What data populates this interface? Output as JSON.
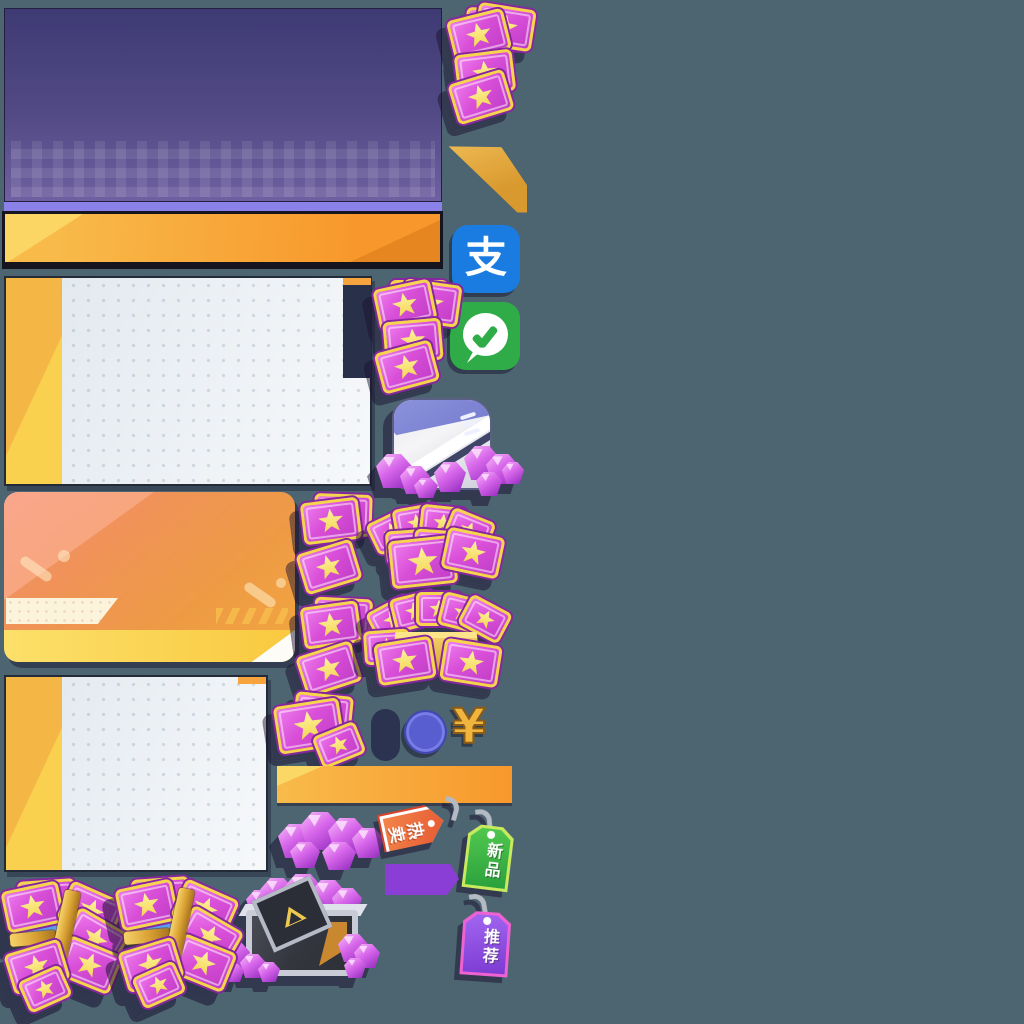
{
  "meta": {
    "kind": "game-shop-sprite-atlas",
    "width": 1024,
    "height": 1024
  },
  "text": {
    "tag_hot": "热卖",
    "tag_new": "新品",
    "tag_recommend": "推荐"
  },
  "icons": {
    "alipay": {
      "name": "alipay-icon",
      "glyph": "支"
    },
    "wechat_pay": {
      "name": "wechat-pay-icon",
      "shape": "white speech bubble with green check"
    },
    "yuan": {
      "name": "yuan-currency-icon",
      "glyph": "¥"
    },
    "coin": {
      "name": "indigo-coin-icon"
    },
    "dark_pill": {
      "name": "dark-pill-placeholder"
    },
    "gem": {
      "name": "purple-gem-icon"
    },
    "ticket": {
      "name": "pink-star-ticket-icon"
    },
    "star": {
      "name": "yellow-star-icon"
    }
  },
  "sprite_names": [
    "purple-banner-panel",
    "banner-divider-strip",
    "orange-header-bar",
    "ticket-stack",
    "gold-corner-ribbon",
    "alipay-icon",
    "wechat-pay-icon",
    "light-panel-with-yellow-edge",
    "currency-pouch-with-gems",
    "orange-gradient-card",
    "ticket-fan-pile",
    "gold-box-of-tickets",
    "dark-pill-placeholder",
    "indigo-coin",
    "yuan-symbol",
    "orange-button-bar",
    "gem-pile",
    "hot-sale-tag",
    "new-item-tag",
    "recommend-tag",
    "purple-parallelogram",
    "metal-crate-of-gems",
    "ticket-bundle-with-gold-bar"
  ],
  "colors": {
    "background": "#4c6571",
    "banner-top": "#3e3a74",
    "banner-mid": "#524a85",
    "banner-bottom": "#6f60a1",
    "banner-strip": "#8b82e9",
    "bar-orange-1": "#f8bb4a",
    "bar-orange-2": "#f8982c",
    "bar-yellow-corner": "#fbd765",
    "panel-yellow-1": "#f4b645",
    "panel-yellow-2": "#fad04f",
    "panel-body-1": "#dfe7ee",
    "panel-body-2": "#f1f4f7",
    "navy-block": "#29304a",
    "navy-strip-orange": "#f7a43e",
    "card-salmon": "#f4937b",
    "card-orange": "#f2a73e",
    "card-cream": "#fbf3da",
    "card-bar-1": "#fce06a",
    "card-bar-2": "#f9c93f",
    "ticket-pink-1": "#ef7ded",
    "ticket-pink-2": "#c03cc6",
    "ticket-gold": "#f6d44e",
    "ticket-outline": "#86279f",
    "star-1": "#fdf2a0",
    "star-2": "#f3d44e",
    "gem-1": "#f5b2f8",
    "gem-2": "#d766ea",
    "gem-3": "#9c33c4",
    "alipay-blue": "#1a7ce0",
    "wechat-green": "#2fab47",
    "coin-indigo": "#5156c9",
    "pill-navy": "#2c3350",
    "yuan-gold": "#f0b53e",
    "gold-1": "#f6d36a",
    "gold-2": "#d9a133",
    "tag-hot-1": "#f2854a",
    "tag-hot-2": "#e34c2c",
    "tag-new-1": "#52c84f",
    "tag-new-2": "#2aa03c",
    "tag-new-border": "#c8ea5e",
    "tag-rec-1": "#a266f0",
    "tag-rec-2": "#7c3ad2",
    "tag-rec-border": "#ef62d4",
    "parallelogram-purple": "#8a3ed6",
    "crate-frame": "#c9ccd6",
    "crate-dark": "#34363f",
    "crate-orange": "#c9872f",
    "pouch-peri": "#8d93dd",
    "hook-gray": "#b4bac4"
  }
}
